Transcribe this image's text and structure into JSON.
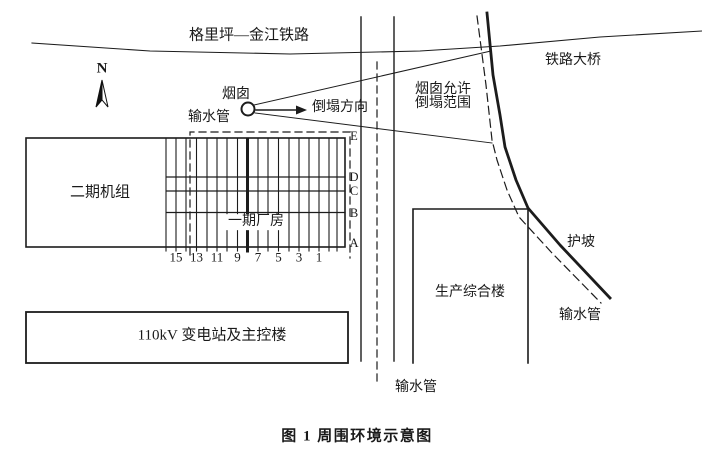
{
  "figure": {
    "caption": "图 1  周围环境示意图",
    "labels": {
      "railway": "格里坪—金江铁路",
      "railway_bridge": "铁路大桥",
      "north": "N",
      "chimney": "烟囱",
      "water_pipe_top": "输水管",
      "collapse_direction": "倒塌方向",
      "collapse_range_line1": "烟囱允许",
      "collapse_range_line2": "倒塌范围",
      "phase2_units": "二期机组",
      "phase1_plant": "一期厂房",
      "production_building": "生产综合楼",
      "substation": "110kV 变电站及主控楼",
      "slope_protection": "护坡",
      "water_pipe_right": "输水管",
      "water_pipe_bottom": "输水管"
    },
    "grid": {
      "column_numbers": [
        "15",
        "13",
        "11",
        "9",
        "7",
        "5",
        "3",
        "1"
      ],
      "row_letters": [
        "E",
        "D",
        "C",
        "B",
        "A"
      ]
    },
    "colors": {
      "ink": "#1c1c1c",
      "paper": "#ffffff"
    }
  }
}
